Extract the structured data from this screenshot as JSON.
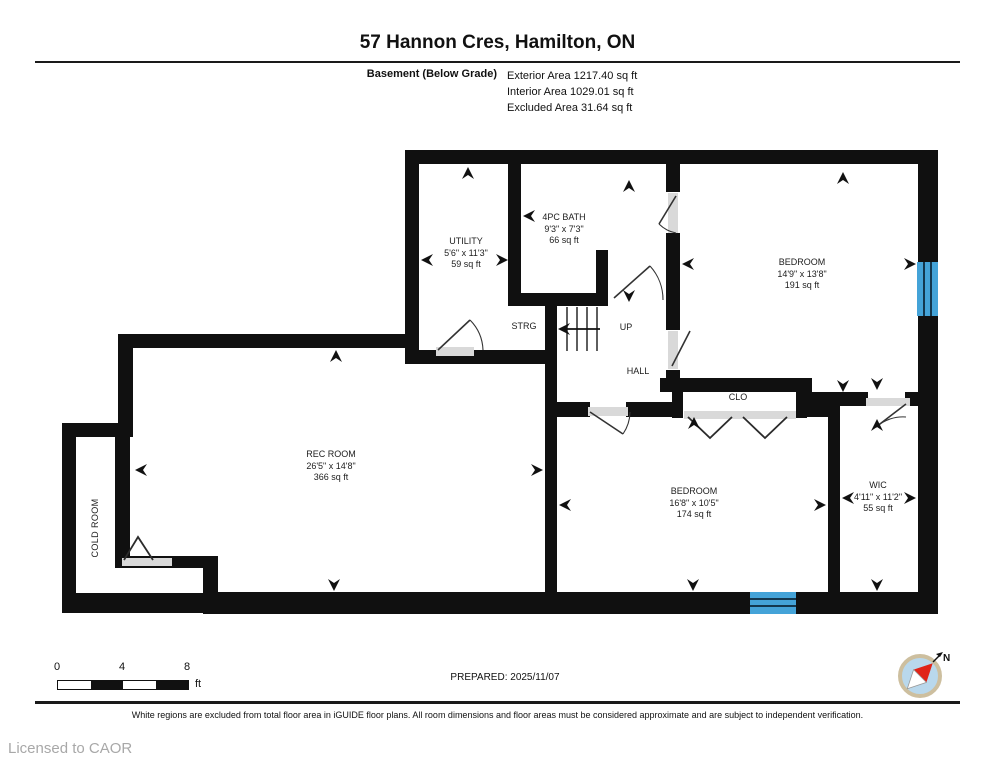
{
  "header": {
    "title": "57 Hannon Cres, Hamilton, ON",
    "floor_label": "Basement (Below Grade)",
    "areas": [
      "Exterior Area 1217.40 sq ft",
      "Interior Area 1029.01 sq ft",
      "Excluded Area 31.64 sq ft"
    ]
  },
  "rooms": {
    "utility": {
      "name": "UTILITY",
      "dims": "5'6\" x 11'3\"",
      "area": "59 sq ft"
    },
    "bath": {
      "name": "4PC BATH",
      "dims": "9'3\" x 7'3\"",
      "area": "66 sq ft"
    },
    "bedroom1": {
      "name": "BEDROOM",
      "dims": "14'9\" x 13'8\"",
      "area": "191 sq ft"
    },
    "rec": {
      "name": "REC ROOM",
      "dims": "26'5\" x 14'8\"",
      "area": "366 sq ft"
    },
    "bedroom2": {
      "name": "BEDROOM",
      "dims": "16'8\" x 10'5\"",
      "area": "174 sq ft"
    },
    "wic": {
      "name": "WIC",
      "dims": "4'11\" x 11'2\"",
      "area": "55 sq ft"
    },
    "strg": {
      "label": "STRG"
    },
    "up": {
      "label": "UP"
    },
    "hall": {
      "label": "HALL"
    },
    "clo": {
      "label": "CLO"
    },
    "cold": {
      "label": "COLD ROOM"
    }
  },
  "scale": {
    "start": "0",
    "mid": "4",
    "end": "8",
    "unit": "ft"
  },
  "prepared": "PREPARED: 2025/11/07",
  "compass": {
    "north": "N"
  },
  "footer": {
    "disclaimer": "White regions are excluded from total floor area in iGUIDE floor plans. All room dimensions and floor areas must be considered approximate and are subject to independent verification.",
    "license": "Licensed to CAOR"
  },
  "colors": {
    "wall": "#101010",
    "room_cream": "#faf3d8",
    "room_beige": "#dcd2c2",
    "bath_blue": "#c9e3f4",
    "window_blue": "#44a3d8",
    "threshold_gray": "#d9d9d9",
    "stairs_gray": "#ececec",
    "compass_ring": "#cdbf9f",
    "compass_face": "#b9d8ec",
    "compass_needle": "#e02418"
  }
}
